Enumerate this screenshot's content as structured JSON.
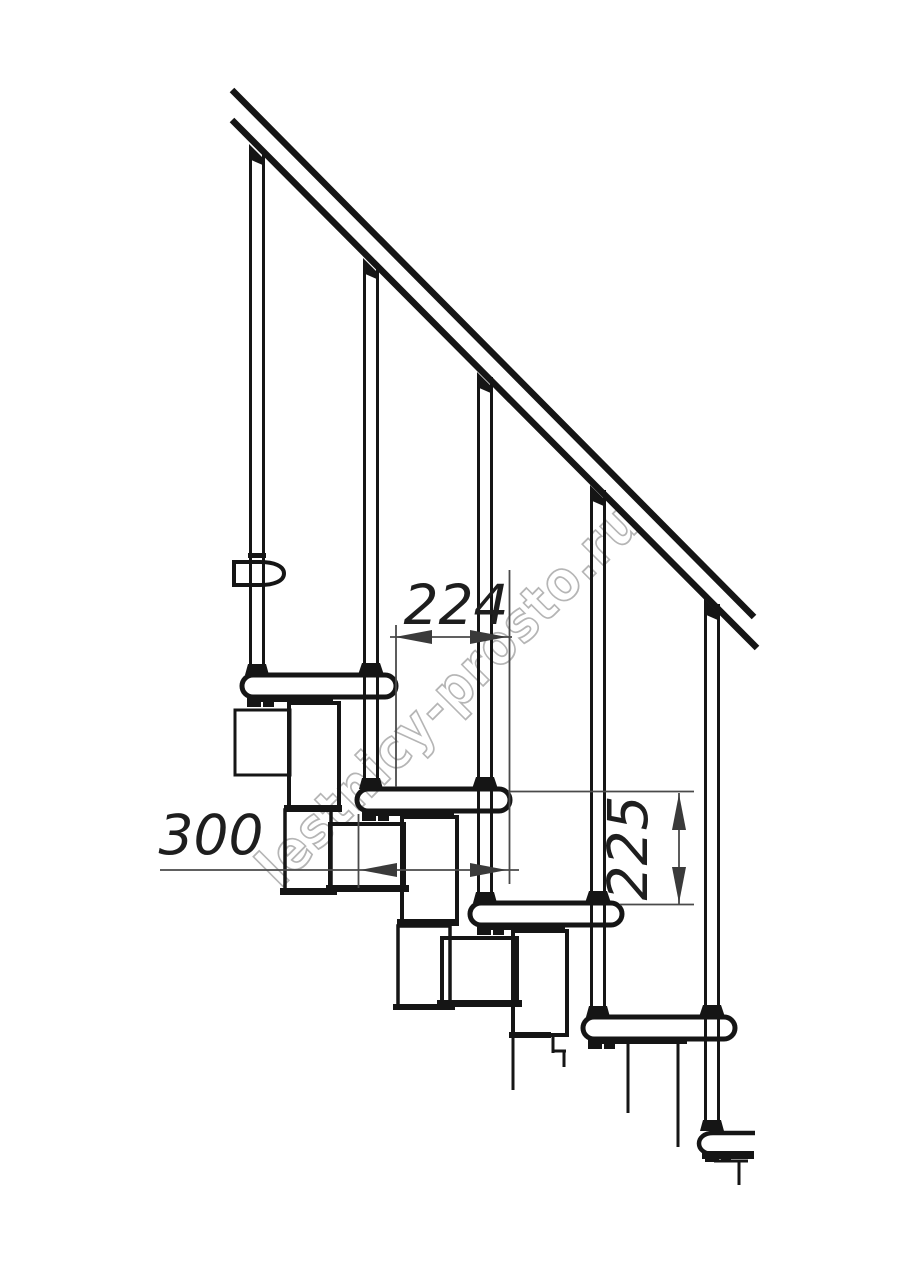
{
  "drawing": {
    "title": "modular-staircase-side-view",
    "watermark_text": "lestnicy-prosto.ru",
    "dimensions": {
      "step_run_mm": "224",
      "tread_depth_mm": "300",
      "riser_height_mm": "225"
    },
    "colors": {
      "line": "#151515",
      "dimension_line": "#4a4a4a",
      "dimension_text": "#1e1e1e",
      "watermark": "#b5b5b5",
      "background": "#ffffff"
    }
  }
}
